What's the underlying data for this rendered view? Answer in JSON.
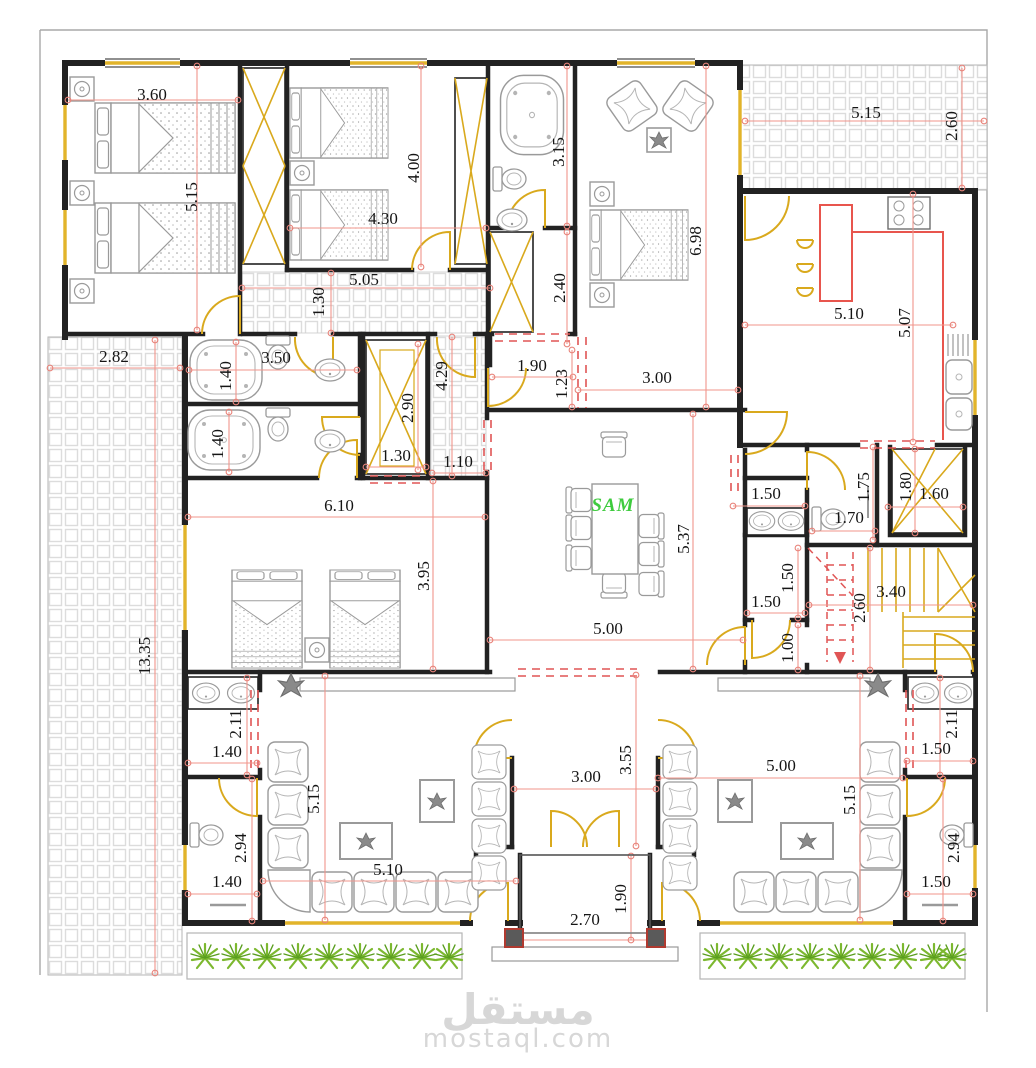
{
  "document": {
    "type": "architectural-floor-plan",
    "table_text": "SAM"
  },
  "watermark": {
    "arabic": "مستقل",
    "latin": "mostaql.com"
  },
  "colors": {
    "wall": "#222222",
    "door": "#d9a91d",
    "window": "#e2b42a",
    "dimension_line": "#f0958b",
    "dimension_text": "#151515",
    "dashed_opening": "#e05555",
    "tile_grid": "#dcdcdc",
    "furniture": "#9a9a9a",
    "kitchen_counter": "#e8554d",
    "plant_green": "#7cb82f",
    "table_text_green": "#3ecb3e",
    "watermark_gray": "#d7d7d7",
    "column_dark": "#5a5a5a"
  },
  "labels": [
    {
      "t": "3.60",
      "x": 152,
      "y": 95,
      "r": 0
    },
    {
      "t": "5.15",
      "x": 192,
      "y": 197,
      "r": 1
    },
    {
      "t": "4.30",
      "x": 383,
      "y": 219,
      "r": 0
    },
    {
      "t": "4.00",
      "x": 414,
      "y": 168,
      "r": 1
    },
    {
      "t": "5.05",
      "x": 364,
      "y": 280,
      "r": 0
    },
    {
      "t": "1.30",
      "x": 319,
      "y": 302,
      "r": 1
    },
    {
      "t": "3.15",
      "x": 559,
      "y": 152,
      "r": 1
    },
    {
      "t": "2.40",
      "x": 560,
      "y": 288,
      "r": 1
    },
    {
      "t": "6.98",
      "x": 696,
      "y": 241,
      "r": 1
    },
    {
      "t": "3.00",
      "x": 657,
      "y": 378,
      "r": 0
    },
    {
      "t": "5.15",
      "x": 866,
      "y": 113,
      "r": 0
    },
    {
      "t": "2.60",
      "x": 952,
      "y": 126,
      "r": 1
    },
    {
      "t": "5.10",
      "x": 849,
      "y": 314,
      "r": 0
    },
    {
      "t": "5.07",
      "x": 905,
      "y": 323,
      "r": 1
    },
    {
      "t": "2.82",
      "x": 114,
      "y": 357,
      "r": 0
    },
    {
      "t": "13.35",
      "x": 145,
      "y": 656,
      "r": 1
    },
    {
      "t": "1.40",
      "x": 226,
      "y": 376,
      "r": 1
    },
    {
      "t": "3.50",
      "x": 276,
      "y": 358,
      "r": 0
    },
    {
      "t": "1.40",
      "x": 218,
      "y": 444,
      "r": 1
    },
    {
      "t": "2.90",
      "x": 408,
      "y": 408,
      "r": 1
    },
    {
      "t": "1.30",
      "x": 396,
      "y": 456,
      "r": 0
    },
    {
      "t": "4.29",
      "x": 442,
      "y": 376,
      "r": 1
    },
    {
      "t": "1.10",
      "x": 458,
      "y": 462,
      "r": 0
    },
    {
      "t": "1.90",
      "x": 532,
      "y": 366,
      "r": 0
    },
    {
      "t": "1.23",
      "x": 562,
      "y": 384,
      "r": 1
    },
    {
      "t": "6.10",
      "x": 339,
      "y": 506,
      "r": 0
    },
    {
      "t": "3.95",
      "x": 424,
      "y": 576,
      "r": 1
    },
    {
      "t": "SAM",
      "x": 613,
      "y": 506,
      "r": 0,
      "c": "sam"
    },
    {
      "t": "5.37",
      "x": 684,
      "y": 539,
      "r": 1
    },
    {
      "t": "5.00",
      "x": 608,
      "y": 629,
      "r": 0
    },
    {
      "t": "1.50",
      "x": 766,
      "y": 494,
      "r": 0
    },
    {
      "t": "1.70",
      "x": 849,
      "y": 518,
      "r": 0
    },
    {
      "t": "1.75",
      "x": 864,
      "y": 487,
      "r": 1
    },
    {
      "t": "1.80",
      "x": 906,
      "y": 487,
      "r": 1
    },
    {
      "t": "1.60",
      "x": 934,
      "y": 494,
      "r": 0
    },
    {
      "t": "1.50",
      "x": 766,
      "y": 602,
      "r": 0
    },
    {
      "t": "1.50",
      "x": 788,
      "y": 578,
      "r": 1
    },
    {
      "t": "2.60",
      "x": 860,
      "y": 608,
      "r": 1
    },
    {
      "t": "3.40",
      "x": 891,
      "y": 592,
      "r": 0
    },
    {
      "t": "1.00",
      "x": 788,
      "y": 648,
      "r": 1
    },
    {
      "t": "2.11",
      "x": 236,
      "y": 724,
      "r": 1
    },
    {
      "t": "1.40",
      "x": 227,
      "y": 752,
      "r": 0
    },
    {
      "t": "2.94",
      "x": 241,
      "y": 848,
      "r": 1
    },
    {
      "t": "1.40",
      "x": 227,
      "y": 882,
      "r": 0
    },
    {
      "t": "5.15",
      "x": 314,
      "y": 799,
      "r": 1
    },
    {
      "t": "5.10",
      "x": 388,
      "y": 870,
      "r": 0
    },
    {
      "t": "3.00",
      "x": 586,
      "y": 777,
      "r": 0
    },
    {
      "t": "3.55",
      "x": 626,
      "y": 760,
      "r": 1
    },
    {
      "t": "2.70",
      "x": 585,
      "y": 920,
      "r": 0
    },
    {
      "t": "1.90",
      "x": 621,
      "y": 899,
      "r": 1
    },
    {
      "t": "5.00",
      "x": 781,
      "y": 766,
      "r": 0
    },
    {
      "t": "5.15",
      "x": 850,
      "y": 800,
      "r": 1
    },
    {
      "t": "2.11",
      "x": 952,
      "y": 724,
      "r": 1
    },
    {
      "t": "1.50",
      "x": 936,
      "y": 749,
      "r": 0
    },
    {
      "t": "2.94",
      "x": 954,
      "y": 848,
      "r": 1
    },
    {
      "t": "1.50",
      "x": 936,
      "y": 882,
      "r": 0
    }
  ]
}
